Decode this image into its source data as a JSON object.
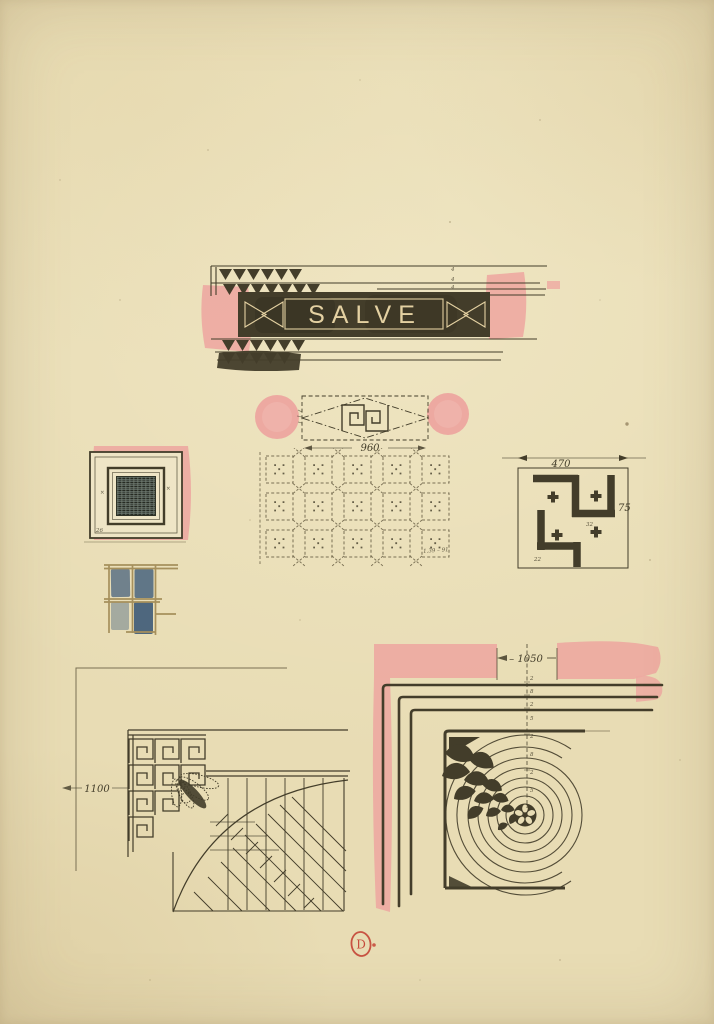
{
  "colors": {
    "paper": "#e8dcb4",
    "paper_light": "#efe5c6",
    "ink": "#433d2a",
    "ink_faint": "#7a7054",
    "cream": "#e4d1a2",
    "pink": "#eda9a1",
    "blue": "#5d7283",
    "tan": "#a6905c",
    "red": "#c23b2e"
  },
  "labels": {
    "salve": "SALVE",
    "dim_960": "960",
    "dim_470": "470",
    "dim_75": "75",
    "dim_1100": "1100",
    "dim_1050": "– 1050",
    "stamp_letter": "D"
  },
  "micro": {
    "band_marks": [
      "4",
      "4",
      "4"
    ],
    "swastika_marks": [
      "32",
      "22"
    ],
    "panel_marks": [
      "×",
      "×",
      "26"
    ],
    "grid_note": "1.39 – 91",
    "frame_marks": [
      "2",
      "8",
      "2",
      "5",
      "2",
      "8",
      "2",
      "5"
    ]
  }
}
